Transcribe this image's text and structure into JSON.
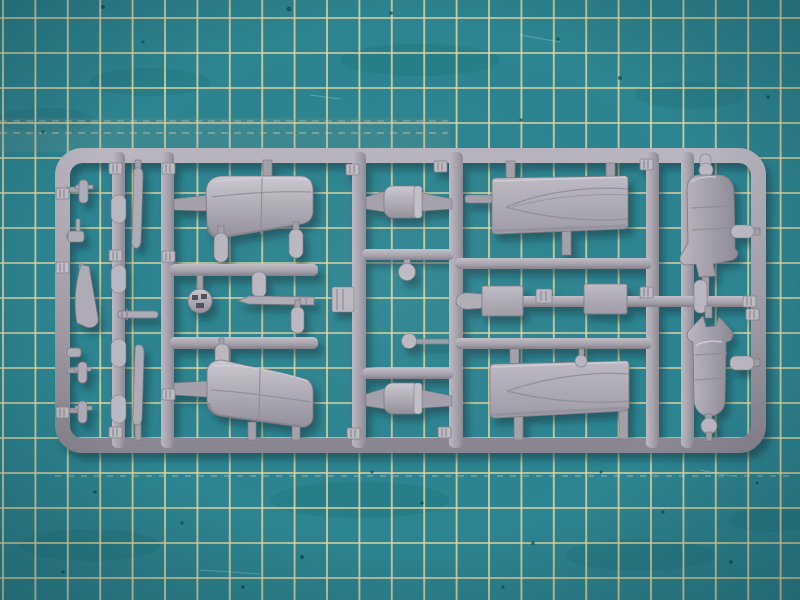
{
  "scene": {
    "description": "Top-down close-up photograph of a light grey injection-moulded plastic model kit sprue (parts runner) holding small-scale aircraft parts, lying on a teal self-healing cutting mat printed with a pale yellow measuring grid",
    "caption": "Grey model aircraft sprue with cowlings, wing halves, fuselage halves and small parts on a teal cutting mat with yellow grid lines"
  },
  "colors": {
    "mat_teal": "#2d8591",
    "mat_teal_dark": "#18626c",
    "grid_line": "#e9d9a2",
    "plastic_light": "#cac7cf",
    "plastic_mid": "#aaa6af",
    "plastic_dark": "#7d7983",
    "sprue_shadow": "#0d3840"
  },
  "mat": {
    "surface": "self-healing cutting mat",
    "grid": {
      "cell_width_px": 32.4,
      "cell_height_px": 35,
      "dashed_guide_rows_y": [
        121,
        133,
        476
      ]
    }
  },
  "sprue": {
    "material": "light grey polystyrene",
    "frame": "rounded rectangular runner frame with six internal vertical runners and connecting cross-runners",
    "parts": [
      {
        "id": "engine-cowling-upper",
        "label": "engine cowling / nacelle half (upper left)"
      },
      {
        "id": "engine-cowling-lower",
        "label": "engine cowling / nacelle half (lower left)"
      },
      {
        "id": "wing-half-upper",
        "label": "wing half with tapered leading-edge engraving (upper right)"
      },
      {
        "id": "wing-half-lower",
        "label": "wing half with tapered leading-edge engraving (lower right)"
      },
      {
        "id": "fuselage-half-upper",
        "label": "fuselage / float half (far right, upper)"
      },
      {
        "id": "fuselage-half-lower",
        "label": "fuselage / float half (far right, lower)"
      },
      {
        "id": "flat-panel-left",
        "label": "rectangular flat panel part (left of pair)"
      },
      {
        "id": "flat-panel-right",
        "label": "rectangular flat panel part (right of pair)"
      },
      {
        "id": "fuel-tank-upper",
        "label": "barrel-shaped tank part between centre runners (upper)"
      },
      {
        "id": "fuel-tank-lower",
        "label": "barrel-shaped tank part between centre runners (lower)"
      },
      {
        "id": "ball-engine-part",
        "label": "ball-shaped part with dark openings"
      },
      {
        "id": "gun-barrel-rod",
        "label": "thin pointed rod / gun barrel part"
      },
      {
        "id": "fin-blade-part",
        "label": "small curved fin blade on left rail"
      },
      {
        "id": "slim-blade-upper",
        "label": "slim tapered blade part (upper left column)"
      },
      {
        "id": "slim-blade-lower",
        "label": "slim tapered blade part (lower left column)"
      },
      {
        "id": "capsule-parts",
        "label": "small capsule / bomb shaped parts on runners",
        "count": 10
      },
      {
        "id": "bullet-parts",
        "label": "bullet-shaped connector parts beside fuselage halves",
        "count": 3
      },
      {
        "id": "number-tabs",
        "label": "small ribbed part-number tabs",
        "count": 14
      }
    ]
  }
}
